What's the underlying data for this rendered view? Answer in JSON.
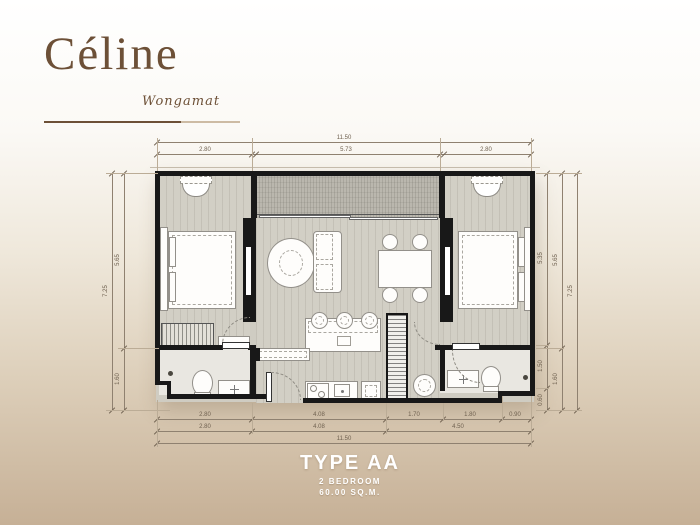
{
  "brand": {
    "name": "Céline",
    "location": "Wongamat"
  },
  "unit": {
    "type": "TYPE AA",
    "bedrooms": "2 BEDROOM",
    "area": "60.00 SQ.M."
  },
  "dimensions": {
    "top_total": "11.50",
    "top_segments": [
      "2.80",
      "5.73",
      "2.80"
    ],
    "bottom_row1": [
      "2.80",
      "4.08",
      "1.70",
      "1.80",
      "0.90"
    ],
    "bottom_row2": [
      "2.80",
      "4.08",
      "4.50"
    ],
    "bottom_total": "11.50",
    "left_outer": "7.25",
    "left_inner": [
      "5.65",
      "1.60"
    ],
    "right_inner": [
      "5.35",
      "1.50",
      "0.60"
    ],
    "right_middle": [
      "5.65",
      "1.60"
    ],
    "right_outer": "7.25"
  },
  "colors": {
    "brand_brown": "#6d5037",
    "wall": "#181818",
    "floor": "#d2cfc5",
    "balcony": "#bab7ae",
    "bathroom": "#e9e7e1",
    "dimension": "#6f6150",
    "label_text": "#ffffff",
    "background_bottom": "#c6b096"
  },
  "furniture_symbols": [
    "double-bed",
    "wardrobe",
    "vanity-table",
    "tv-wall",
    "armchair",
    "sofa",
    "dining-table",
    "dining-chair",
    "kitchen-island",
    "bar-stool",
    "stove",
    "sink",
    "refrigerator",
    "washing-machine",
    "toilet",
    "washbasin",
    "shower-drain",
    "storage-cabinet",
    "service-shaft",
    "sliding-door",
    "door-swing"
  ]
}
